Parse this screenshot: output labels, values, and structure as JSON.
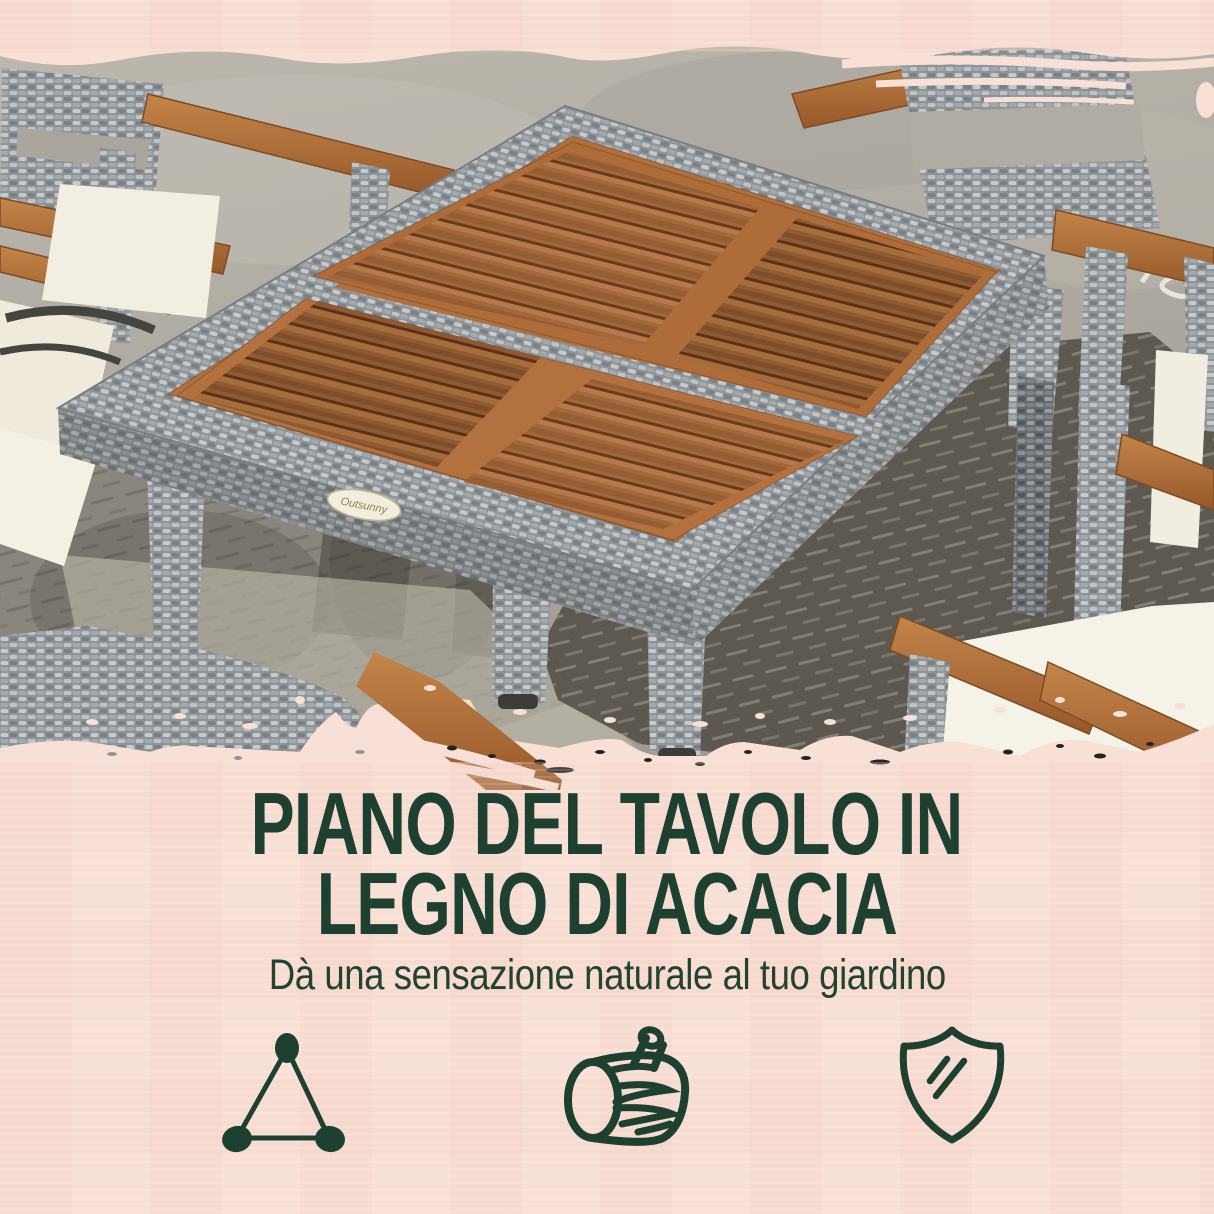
{
  "headline": {
    "line1": "PIANO DEL TAVOLO IN",
    "line2": "LEGNO DI ACACIA"
  },
  "subheadline": "Dà una sensazione naturale al tuo giardino",
  "brand_tag": "Outsunny",
  "features": [
    "stability-triangle-icon",
    "wood-log-icon",
    "shield-icon"
  ],
  "colors": {
    "background_pink": "#f8e0d7",
    "text_green": "#1d4030",
    "wood_brown": "#ad6c3a",
    "wicker_grey": "#9b9fa3",
    "cushion_cream": "#f3efe2",
    "concrete_grey": "#aeaaa1",
    "shadow_grey": "#57534a"
  }
}
